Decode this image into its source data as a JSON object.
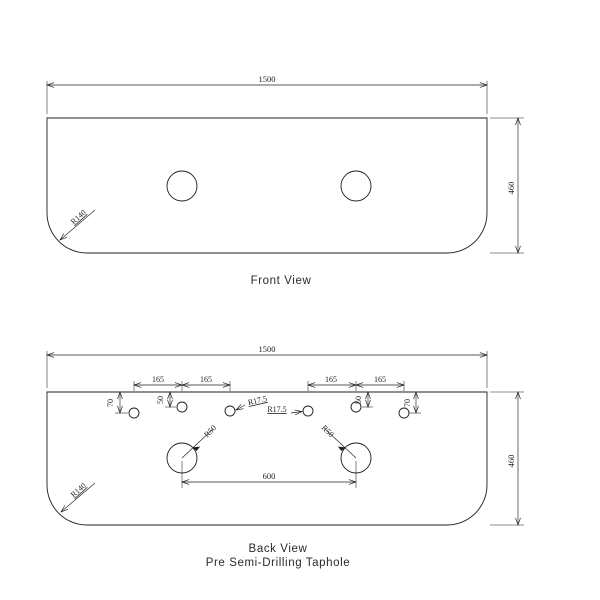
{
  "colors": {
    "line": "#1f1f1f",
    "background": "#ffffff"
  },
  "front_view": {
    "caption": "Front View",
    "dims": {
      "width": "1500",
      "height": "460",
      "corner_radius": "R140"
    }
  },
  "back_view": {
    "caption": "Back View",
    "subcaption": "Pre Semi-Drilling Taphole",
    "dims": {
      "width": "1500",
      "height": "460",
      "corner_radius": "R140",
      "hole_spacing_1": "165",
      "hole_spacing_2": "165",
      "hole_spacing_3": "165",
      "hole_spacing_4": "165",
      "edge_offset_left": "70",
      "edge_offset_left_inner": "50",
      "edge_offset_right_inner": "50",
      "edge_offset_right": "70",
      "taphole_radius_1": "R17.5",
      "taphole_radius_2": "R17.5",
      "basin_hole_radius_left": "R50",
      "basin_hole_radius_right": "R50",
      "basin_center_spacing": "600"
    }
  }
}
